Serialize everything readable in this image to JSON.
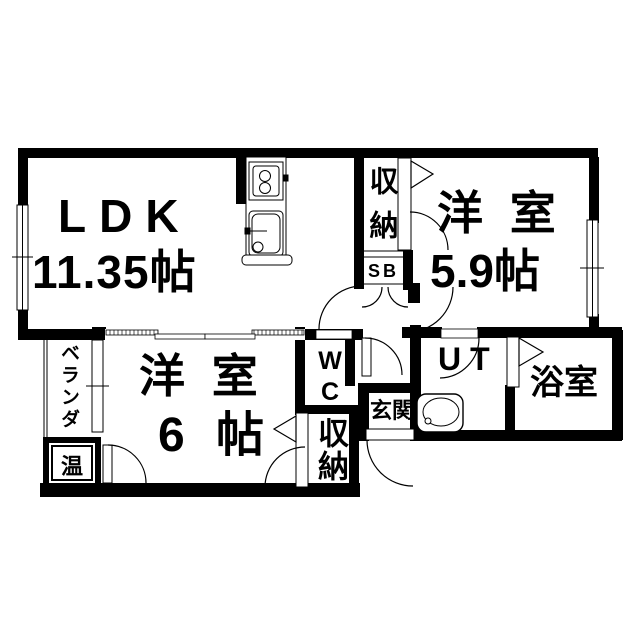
{
  "floorplan": {
    "type": "japanese-apartment-floor-plan",
    "colors": {
      "wall": "#000000",
      "floor": "#ffffff",
      "line": "#000000"
    },
    "rooms": {
      "ldk": {
        "label": "LDK",
        "size": "11.35帖"
      },
      "western_room_59": {
        "label": "洋 室",
        "size": "5.9帖"
      },
      "western_room_6": {
        "label": "洋 室",
        "size": "6 帖"
      },
      "bathroom": {
        "label": "浴室"
      },
      "utility": {
        "label": "UT"
      },
      "entrance": {
        "label": "玄関"
      },
      "toilet": {
        "label": "WC"
      },
      "closet_top": {
        "label": "収納"
      },
      "closet_bottom": {
        "label": "収納"
      },
      "shoe_box": {
        "label": "SB"
      },
      "veranda": {
        "label": "ベランダ"
      },
      "water_heater": {
        "label": "温"
      }
    }
  }
}
